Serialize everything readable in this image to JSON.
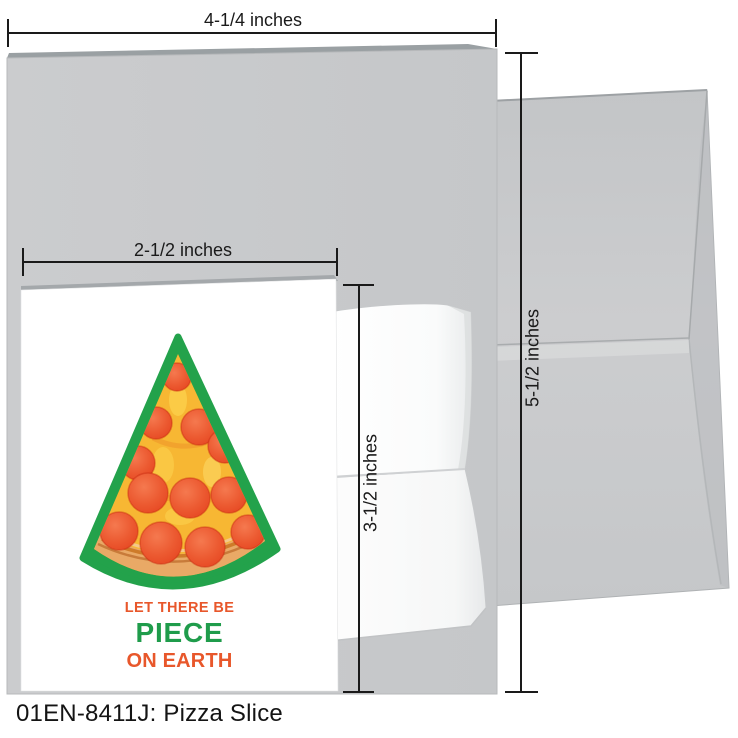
{
  "scene": {
    "caption": "01EN-8411J: Pizza Slice"
  },
  "measurements": {
    "large_card_width": "4-1/4 inches",
    "large_card_height": "5-1/2 inches",
    "small_card_width": "2-1/2 inches",
    "small_card_height": "3-1/2 inches"
  },
  "card": {
    "line1": "LET THERE BE",
    "line2": "PIECE",
    "line3": "ON EARTH"
  },
  "colors": {
    "accent_orange": "#E8572B",
    "accent_green": "#1F9C4B",
    "pizza_outline_green": "#23A24B",
    "cheese_yellow": "#F7B733",
    "cheese_light": "#FCD24E",
    "crust_tan": "#E9A966",
    "crust_dark": "#C9731F",
    "pepperoni_red": "#E5431F",
    "pepperoni_light": "#F5794F",
    "paper_gray": "#C8C9CB",
    "dimension_black": "#1A1A1A"
  }
}
